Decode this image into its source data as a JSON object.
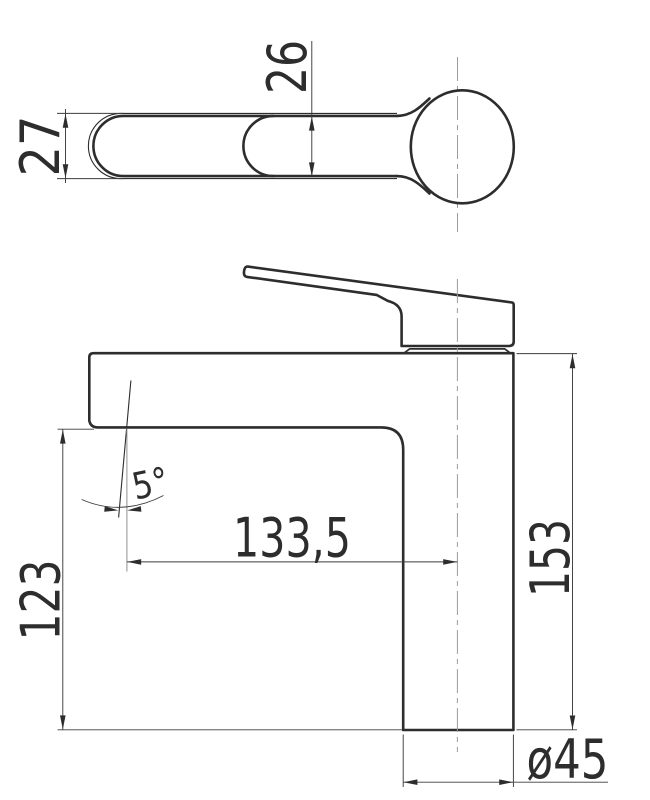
{
  "drawing": {
    "description": "Technical dimension drawing of a single-lever basin faucet, top view of handle and side elevation",
    "colors": {
      "background": "#ffffff",
      "object_line": "#2d2d2d",
      "dimension_line": "#3c3c3c",
      "centerline": "#9c9c9c"
    },
    "top_view": {
      "dim_handle_outer_width": "27",
      "dim_handle_inner_width": "26"
    },
    "side_view": {
      "dim_spout_reach": "133,5",
      "dim_spout_outlet_height": "123",
      "dim_total_height": "153",
      "dim_base_diameter": "ø45",
      "dim_stream_angle": "5°"
    }
  }
}
